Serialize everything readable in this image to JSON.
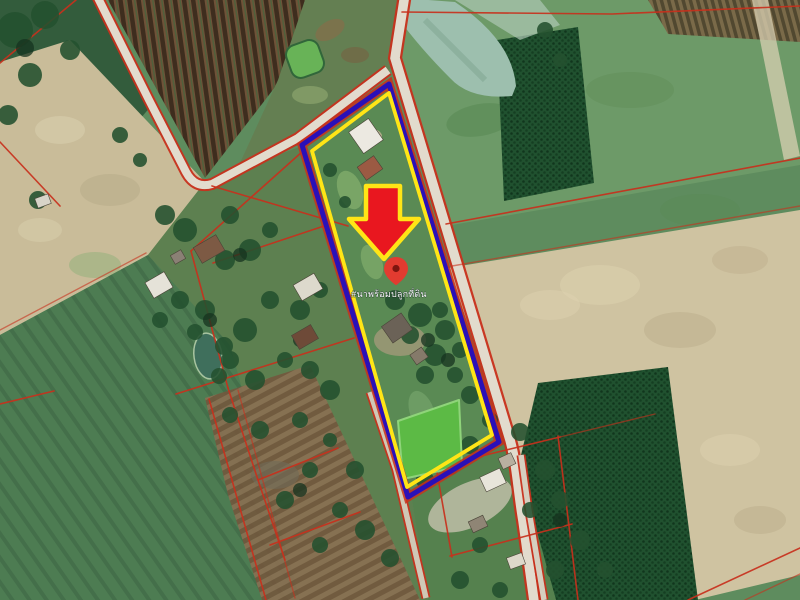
{
  "map": {
    "type": "satellite-land-listing-photo",
    "label": {
      "text": "#นาพร้อมปลูกที่ดิน"
    },
    "icons": {
      "arrow": "red-down-arrow-icon",
      "pin": "location-pin-icon"
    },
    "colors": {
      "parcel_outline_outer": "#2a10b8",
      "parcel_outline_inner": "#ffe516",
      "cadastral_line": "#c8301c",
      "arrow_fill": "#e9171f",
      "arrow_outline": "#ffe516",
      "pin_color": "#e23b30",
      "pin_dot": "#7e150f",
      "road_surface": "#e2dbcd",
      "parcel_pond": "#5cba45",
      "canal_water": "#9dbfae",
      "village_pond": "#3f6f5c"
    }
  }
}
